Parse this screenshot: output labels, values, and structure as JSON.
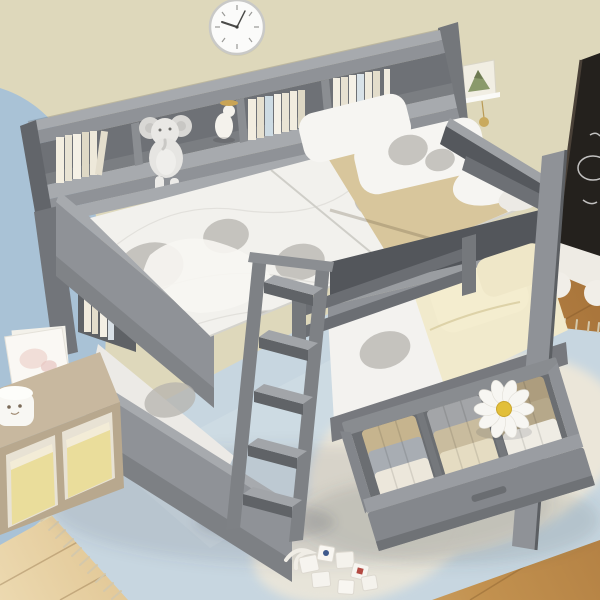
{
  "scene": {
    "description": "Product photo of a gray full-over-full bunk bed with headboard bookshelf, guardrails, front ladder and an open under-bed storage drawer, staged in a kids bedroom with beige and blue walls, wood floor and layered rugs",
    "objects": {
      "wall": "beige wall",
      "accent_wall": "light blue accent wall",
      "floor": "wood plank floor",
      "rug_blue": "light blue tasseled rug",
      "rug_cream": "cream shag rug",
      "clock": "round white wall clock",
      "wall_decor": "small triangle art shelf with charm",
      "chalkboard": "black chalkboard with white doodles",
      "chalk_tray": "white rolling tray under chalkboard",
      "bunk_bed": "gray full over full bunk bed",
      "headboard_shelf": "headboard bookshelf with compartments",
      "books": "white and cream book spines",
      "elephant_plush": "gray elephant plush sitting on shelf",
      "figurine": "small white animal figurine with gold dish",
      "top_mattress": "white quilted mattress with gray cloud pattern",
      "pillows_top": "two white pillows with gray pattern",
      "blanket_tan": "folded tan blanket",
      "guard_rail_foot": "foot guard rail",
      "guard_rail_side": "side guard rail",
      "lower_bunk": "lower bunk with cream blanket and pillows",
      "ladder": "gray angled ladder with flat steps",
      "drawer": "open storage drawer with folded clothes",
      "folded_clothes": "folded clothes in white, gray and tan",
      "daisy_cushion": "white daisy flower cushion",
      "art_print": "white art print leaning on wall",
      "cubby_shelf": "tan cubby shelf with yellow bins",
      "round_toy": "small white round toy",
      "toy_blocks": "white toy blocks on rug"
    },
    "counts": {
      "shelf_compartments": 4,
      "ladder_steps": 5,
      "drawer_clothes_items": 9,
      "daisy_petals": 10
    }
  },
  "colors": {
    "wall": "#ded8bb",
    "accent_wall": "#a9c2d6",
    "floor_light": "#ecd9b0",
    "floor_dark": "#a9753b",
    "rug_blue": "#c7d6e0",
    "rug_cream": "#ebe6d9",
    "fringe": "#d4c8ab",
    "bed_gray": "#8f9297",
    "bed_gray_light": "#a7aaae",
    "bed_gray_dark": "#6e7176",
    "frame_dark": "#55585d",
    "mattress_white": "#f2f1ed",
    "mattress_pattern": "#b5b3ae",
    "blanket_tan": "#d8c69c",
    "blanket_cream": "#f1eacc",
    "pillow_white": "#f6f5f2",
    "chalkboard": "#24211d",
    "tray_white": "#eeebe4",
    "book_cream": "#f0ebdc",
    "bin_yellow": "#eadd9b",
    "cubby_tan": "#c8b89f",
    "daisy_petal": "#f7f6f2",
    "daisy_center": "#e2bf3a",
    "clock_face": "#fbfbfa",
    "clock_rim": "#c9c9c7"
  }
}
